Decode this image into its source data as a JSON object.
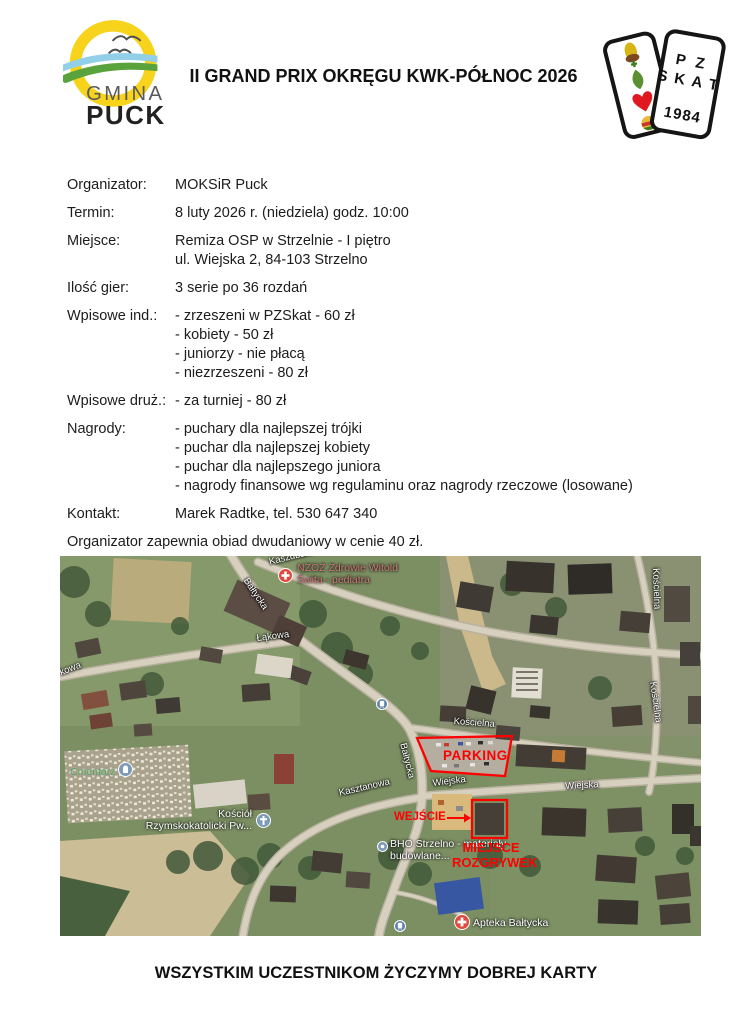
{
  "header": {
    "title": "II GRAND PRIX OKRĘGU KWK-PÓŁNOC 2026",
    "gmina_logo": {
      "line1": "GMINA",
      "line2": "PUCK"
    },
    "pzskat_logo": {
      "line1": "P Z",
      "line2": "S K A T",
      "year": "1984"
    }
  },
  "details": [
    {
      "label": "Organizator:",
      "lines": [
        "MOKSiR Puck"
      ]
    },
    {
      "label": "Termin:",
      "lines": [
        "8 luty 2026 r. (niedziela) godz. 10:00"
      ]
    },
    {
      "label": "Miejsce:",
      "lines": [
        "Remiza OSP w Strzelnie - I piętro",
        "ul. Wiejska 2, 84-103 Strzelno"
      ]
    },
    {
      "label": "Ilość gier:",
      "lines": [
        "3 serie po 36 rozdań"
      ]
    },
    {
      "label": "Wpisowe ind.:",
      "lines": [
        "- zrzeszeni w PZSkat - 60 zł",
        "- kobiety - 50 zł",
        "- juniorzy - nie płacą",
        "- niezrzeszeni - 80 zł"
      ]
    },
    {
      "label": "Wpisowe druż.:",
      "lines": [
        "- za turniej - 80 zł"
      ]
    },
    {
      "label": "Nagrody:",
      "lines": [
        "- puchary dla najlepszej trójki",
        "- puchar dla najlepszej kobiety",
        "- puchar dla najlepszego juniora",
        "- nagrody finansowe wg regulaminu oraz nagrody rzeczowe (losowane)"
      ]
    },
    {
      "label": "Kontakt:",
      "lines": [
        "Marek Radtke, tel. 530 647 340"
      ]
    }
  ],
  "note": "Organizator zapewnia obiad dwudaniowy w cenie 40 zł.",
  "map": {
    "streets": [
      "Kaszubska",
      "Bałtycka",
      "Łąkowa",
      "kowa",
      "Kościelna",
      "Kościelna",
      "Kościelna",
      "Bałtycka",
      "Wiejska",
      "Wiejska",
      "Kasztanowa"
    ],
    "pois": {
      "nzoz": {
        "line1": "NZOZ Zdrowie Witold",
        "line2": "Świta - pediatra"
      },
      "cmentarz": "Cmentarz",
      "kosciol": {
        "line1": "Kościół",
        "line2": "Rzymskokatolicki Pw..."
      },
      "bho": {
        "line1": "BHO Strzelno - materiały",
        "line2": "budowlane..."
      },
      "apteka": "Apteka Bałtycka"
    },
    "annotations": {
      "parking": "PARKING",
      "entrance": "WEJŚCIE",
      "venue_line1": "MIEJSCE",
      "venue_line2": "ROZGRYWEK"
    }
  },
  "footer": "WSZYSTKIM UCZESTNIKOM ŻYCZYMY DOBREJ KARTY",
  "colors": {
    "annotation_red": "#ff0000",
    "street_label": "#ffffff",
    "cemetery_label_green": "#56a05a",
    "health_label_pink": "#cd7a76",
    "sun_yellow": "#f8d31c",
    "wave_blue": "#92cfe9",
    "wave_green": "#5aa33c",
    "heart_red": "#e0191f",
    "leaf_green": "#5a9032",
    "acorn_yellow": "#d8b517",
    "bell_orange": "#e8b93a"
  }
}
